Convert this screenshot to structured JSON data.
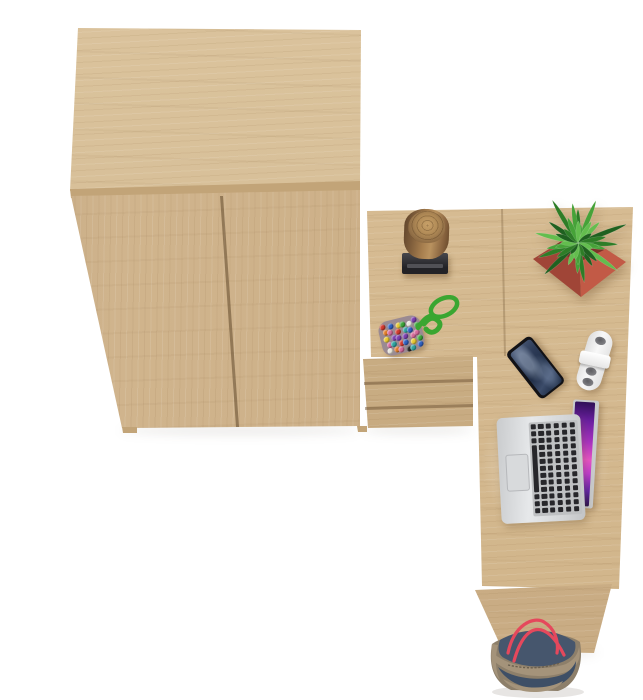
{
  "scene": {
    "label": "Top-down product photo of a light oak office set: two-door wardrobe, L-shaped corner desk with three-drawer pedestal, and desk accessories on a white floor",
    "background": "#ffffff"
  },
  "furniture": {
    "wardrobe": {
      "label": "two-door wardrobe cabinet, light oak",
      "doors": 2
    },
    "desk": {
      "label": "L-shaped corner desk top, light oak"
    },
    "drawer_unit": {
      "label": "three-drawer pedestal under desk",
      "drawers": 3
    },
    "desk_leg": {
      "label": "desk side leg panel"
    }
  },
  "items": {
    "log": {
      "label": "decorative wooden log sculpture on black stand"
    },
    "plant": {
      "label": "green spiky plant in red square planter"
    },
    "bead_toy": {
      "label": "multicolor bead pad keychain with green paracord loop"
    },
    "phone": {
      "label": "black smartphone, screen up"
    },
    "cable_organizer": {
      "label": "white cable organizer / charger"
    },
    "laptop": {
      "label": "open silver laptop with purple wallpaper"
    },
    "bag": {
      "label": "denim and canvas tote bag with red rope straps"
    }
  },
  "colors": {
    "background": "#ffffff",
    "wood_top": "#d8bf96",
    "wood_front": "#cfb289",
    "wood_desk": "#d6ba8f",
    "wood_drawer": "#c9ac81",
    "wood_leg": "#cdb087",
    "wood_edge": "#c2a478",
    "stand_dark": "#222226",
    "stand_light": "#47474c",
    "log_bark_dark": "#5f432a",
    "log_bark_light": "#b9925f",
    "log_top_light": "#c8a169",
    "pot_left": "#a04537",
    "pot_right": "#c25a46",
    "phone_body": "#121216",
    "phone_screen_a": "#4a5a78",
    "phone_screen_b": "#1a2840",
    "charger_body": "#f8f8f8",
    "charger_hole": "#8e8e92",
    "laptop_silver_a": "#c9cbcd",
    "laptop_silver_b": "#e6e8ea",
    "key_dark": "#27272b",
    "trackpad": "#d8dadc",
    "screen_pink": "#e853c6",
    "bag_denim": "#46566d",
    "bag_denim_dark": "#3e4f66",
    "bag_trim": "#a4937a",
    "bag_trim_dark": "#8d7f6a",
    "bag_strap": "#e5485c",
    "cord_green": "#3aa631"
  },
  "plant_greens": [
    "#2e7d27",
    "#46a238",
    "#63bd4e",
    "#1f6120"
  ],
  "bead_palette": [
    "#d23b2f",
    "#2f61c2",
    "#e8c832",
    "#3da43a",
    "#e8e4da",
    "#7b3fae",
    "#e07b28",
    "#2b2b2b",
    "#d46a9a",
    "#2fa3a0"
  ]
}
